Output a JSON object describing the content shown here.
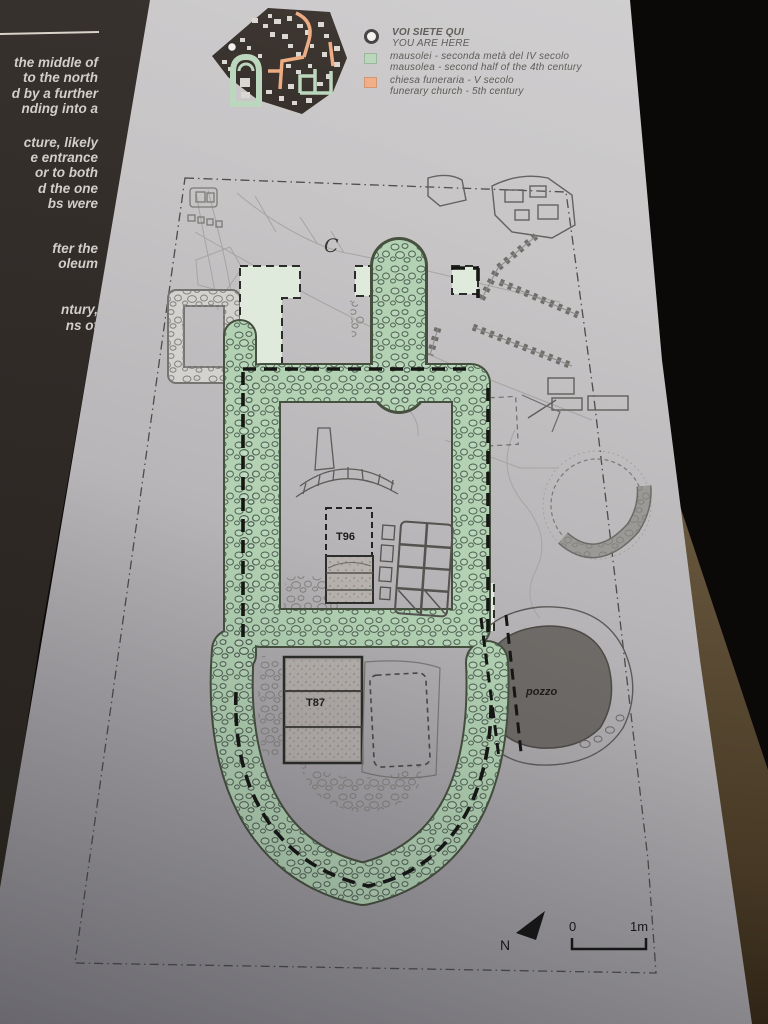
{
  "sidebar": {
    "lines": [
      "the middle of",
      "to  the  north",
      "d by a further",
      "nding into a",
      "cture, likely",
      "e entrance",
      "or to both",
      "d the one",
      "bs were",
      "fter the",
      "oleum",
      "ntury,",
      "ns of"
    ]
  },
  "legend": {
    "marker": {
      "it": "VOI SIETE QUI",
      "en": "YOU ARE HERE"
    },
    "items": [
      {
        "key": "mausolea",
        "color": "#b7d5b9",
        "it": "mausolei - seconda metà del IV secolo",
        "en": "mausolea - second half of the 4th century"
      },
      {
        "key": "funerary-church",
        "color": "#efab84",
        "it": "chiesa funeraria - V secolo",
        "en": "funerary church - 5th century"
      }
    ]
  },
  "plan": {
    "labels": {
      "area_c": "C",
      "tomb_96": "T96",
      "tomb_87": "T87",
      "well": "pozzo"
    },
    "compass_north": "N",
    "scale": {
      "zero": "0",
      "one_meter": "1m"
    }
  },
  "colors": {
    "mausolea_green": "#b7d5b9",
    "church_orange": "#efab84",
    "panel_light": "#c6c4c5",
    "sidebar_brown": "#2e2825",
    "background_dark": "#0b0908",
    "well_fill": "#6e6a67"
  }
}
